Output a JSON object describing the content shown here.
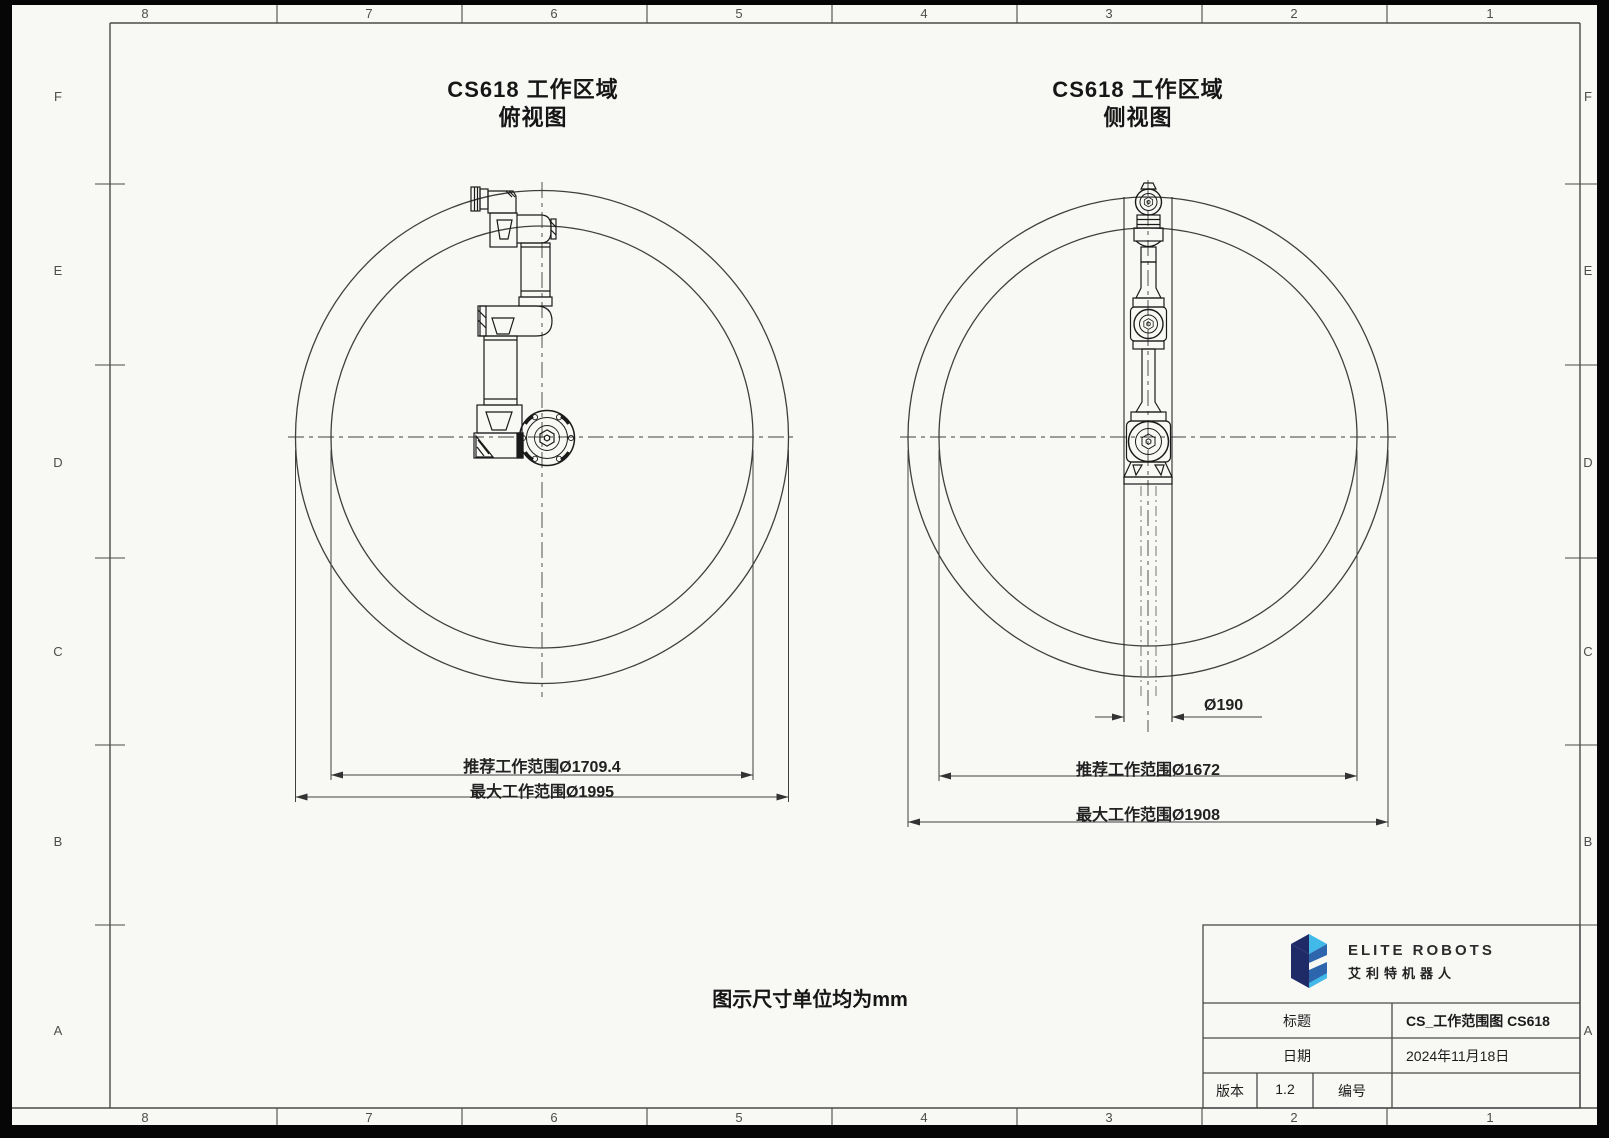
{
  "colors": {
    "paper": "#f8f8f5",
    "frame_line": "#4a4a4a",
    "drawing_line": "#3f3f3f",
    "robot_line": "#1a1a1a",
    "logo_navy": "#1e2b66",
    "logo_blue": "#2e66ad",
    "logo_cyan": "#41b9e9"
  },
  "frame": {
    "columns": [
      "8",
      "7",
      "6",
      "5",
      "4",
      "3",
      "2",
      "1"
    ],
    "rows": [
      "F",
      "E",
      "D",
      "C",
      "B",
      "A"
    ]
  },
  "top_view": {
    "title": "CS618 工作区域",
    "subtitle": "俯视图",
    "dim_recommended": "推荐工作范围Ø1709.4",
    "dim_max": "最大工作范围Ø1995"
  },
  "side_view": {
    "title": "CS618 工作区域",
    "subtitle": "侧视图",
    "dim_base": "Ø190",
    "dim_recommended": "推荐工作范围Ø1672",
    "dim_max": "最大工作范围Ø1908"
  },
  "note": "图示尺寸单位均为mm",
  "title_block": {
    "brand_en": "ELITE ROBOTS",
    "brand_cn": "艾利特机器人",
    "title_label": "标题",
    "title_value": "CS_工作范围图 CS618",
    "date_label": "日期",
    "date_value": "2024年11月18日",
    "version_label": "版本",
    "version_value": "1.2",
    "number_label": "编号",
    "number_value": ""
  }
}
